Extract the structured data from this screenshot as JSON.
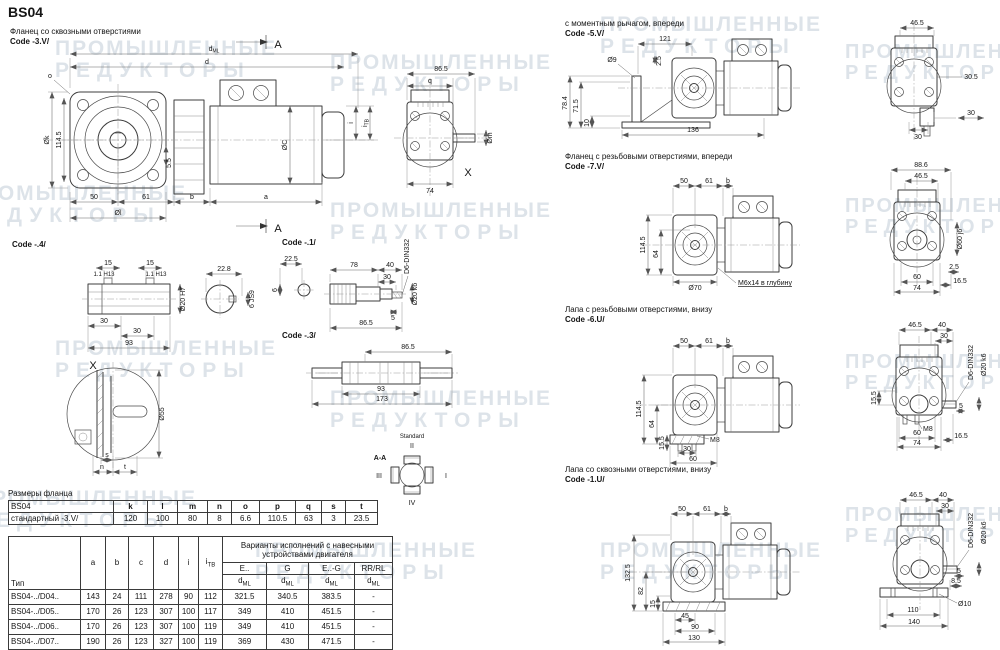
{
  "page": {
    "title": "BS04",
    "wm1": "ПРОМЫШЛЕННЫЕ",
    "wm2": "РЕДУКТОРЫ"
  },
  "sec3v": {
    "title": "Фланец со сквозными отверстиями",
    "code": "Code -3.V/",
    "mark": "A",
    "d": {
      "dml_m": "d",
      "dml_s": "ML",
      "d": "d",
      "ok": "Øk",
      "h1145": "114.5",
      "o": "o",
      "n55": "5.5",
      "n50": "50",
      "n61": "61",
      "b": "b",
      "a": "a",
      "ol": "Øl",
      "oc": "ØC",
      "i": "i",
      "itb_m": "i",
      "itb_s": "TB"
    },
    "e": {
      "n865": "86.5",
      "q": "q",
      "n74": "74",
      "om": "Øm",
      "x": "X"
    }
  },
  "sec4": {
    "code": "Code -.4/",
    "d": {
      "n15a": "15",
      "h13a": "1.1 H13",
      "n15b": "15",
      "h13b": "1.1 H13",
      "n228": "22.8",
      "n30a": "30",
      "n30b": "30",
      "n93": "93",
      "o20": "Ø20 H7",
      "js9": "6 JS9"
    }
  },
  "sec1": {
    "code": "Code -.1/",
    "d": {
      "n225": "22.5",
      "n6": "6",
      "n78": "78",
      "n40": "40",
      "n30": "30",
      "din": "D6-DIN332",
      "n5": "5",
      "n865": "86.5",
      "o20": "Ø20 k6"
    }
  },
  "sec3": {
    "code": "Code -.3/",
    "d": {
      "n865": "86.5",
      "n93": "93",
      "n173": "173"
    }
  },
  "xd": {
    "x": "X",
    "o55": "Ø55",
    "s": "s",
    "n": "n",
    "t": "t"
  },
  "aa": {
    "t": "A-A",
    "std": "Standard",
    "p1": "I",
    "p2": "II",
    "p3": "III",
    "p4": "IV"
  },
  "sec5v": {
    "title": "с моментным рычагом, впереди",
    "code": "Code -5.V/",
    "d": {
      "n121": "121",
      "o9": "Ø9",
      "n25": "2.5",
      "n784": "78.4",
      "n715": "71.5",
      "n10": "10",
      "n136": "136"
    },
    "e": {
      "n465": "46.5",
      "n305": "30.5",
      "n30a": "30",
      "n30b": "30"
    }
  },
  "sec7v": {
    "title": "Фланец с резьбовыми отверстиями, впереди",
    "code": "Code -7.V/",
    "d": {
      "n50": "50",
      "n61": "61",
      "b": "b",
      "n1145": "114.5",
      "n64": "64",
      "o70": "Ø70",
      "note": "М6х14 в глубину"
    },
    "e": {
      "n886": "88.6",
      "n465": "46.5",
      "o60": "Ø60 j6",
      "n25": "2.5",
      "n60": "60",
      "n165": "16.5",
      "n74": "74"
    }
  },
  "sec6u": {
    "title": "Лапа с резьбовыми отверстиями, внизу",
    "code": "Code -6.U/",
    "d": {
      "n50": "50",
      "n61": "61",
      "b": "b",
      "n1145": "114.5",
      "n64": "64",
      "n155": "15.5",
      "m8": "M8",
      "n30": "30",
      "n60": "60"
    },
    "e": {
      "n465": "46.5",
      "n40": "40",
      "n30": "30",
      "din": "D6-DIN332",
      "o20": "Ø20 k6",
      "n155": "15.5",
      "m8": "M8",
      "n5": "5",
      "n60": "60",
      "n165": "16.5",
      "n74": "74"
    }
  },
  "sec1u": {
    "title": "Лапа со сквозными отверстиями, внизу",
    "code": "Code -1.U/",
    "d": {
      "n50": "50",
      "n61": "61",
      "b": "b",
      "n1325": "132.5",
      "n82": "82",
      "n15": "15",
      "n45": "45",
      "n90": "90",
      "n130": "130"
    },
    "e": {
      "n465": "46.5",
      "n40": "40",
      "n30": "30",
      "din": "D6-DIN332",
      "o20": "Ø20 k6",
      "n5": "5",
      "n85": "8.5",
      "o10": "Ø10",
      "n110": "110",
      "n140": "140"
    }
  },
  "flange_table": {
    "title": "Размеры фланца",
    "h": [
      "BS04",
      "k",
      "l",
      "m",
      "n",
      "o",
      "p",
      "q",
      "s",
      "t"
    ],
    "r": [
      "стандартный -3.V/",
      "120",
      "100",
      "80",
      "8",
      "6.6",
      "110.5",
      "63",
      "3",
      "23.5"
    ]
  },
  "main_table": {
    "vt1": "Варианты исполнений с навесными",
    "vt2": "устройствами двигателя",
    "type": "Тип",
    "a": "a",
    "b": "b",
    "c": "c",
    "d": "d",
    "i": "i",
    "itb_m": "i",
    "itb_s": "TB",
    "v1": "E..",
    "v2": "G",
    "v3": "E..-G",
    "v4": "RR/RL",
    "dml_m": "d",
    "dml_s": "ML",
    "rows": [
      {
        "t": "BS04-../D04..",
        "a": "143",
        "b": "24",
        "c": "111",
        "d": "278",
        "i": "90",
        "itb": "112",
        "e": "321.5",
        "g": "340.5",
        "eg": "383.5",
        "rr": "-"
      },
      {
        "t": "BS04-../D05..",
        "a": "170",
        "b": "26",
        "c": "123",
        "d": "307",
        "i": "100",
        "itb": "117",
        "e": "349",
        "g": "410",
        "eg": "451.5",
        "rr": "-"
      },
      {
        "t": "BS04-../D06..",
        "a": "170",
        "b": "26",
        "c": "123",
        "d": "307",
        "i": "100",
        "itb": "119",
        "e": "349",
        "g": "410",
        "eg": "451.5",
        "rr": "-"
      },
      {
        "t": "BS04-../D07..",
        "a": "190",
        "b": "26",
        "c": "123",
        "d": "327",
        "i": "100",
        "itb": "119",
        "e": "369",
        "g": "430",
        "eg": "471.5",
        "rr": "-"
      }
    ]
  }
}
